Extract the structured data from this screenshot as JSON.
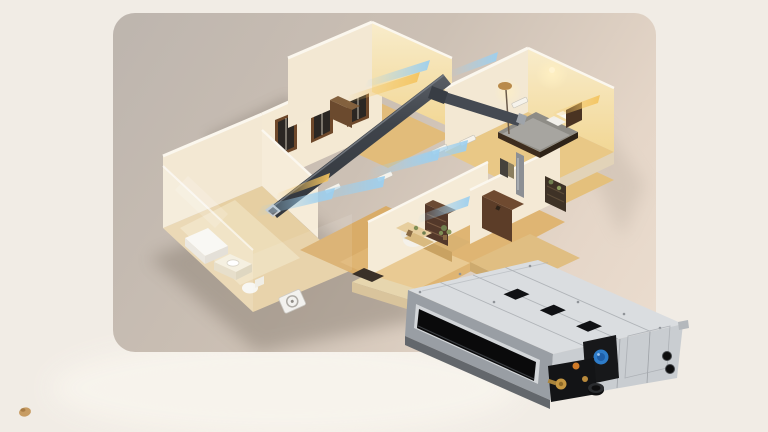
{
  "scene": {
    "description-elements": [
      "isometric-cutaway-house-model",
      "ceiling-air-duct",
      "cool-airflow-streams",
      "warm-airflow-streams",
      "bathroom-with-glass-wall",
      "dining-area",
      "wardrobe-room",
      "bedroom-with-bed-and-floor-lamp",
      "outdoor-condenser-unit",
      "ducted-ac-indoor-unit-product"
    ]
  },
  "colors": {
    "bg-outer": "#F1ECE5",
    "bg-glow": "#F8F4ED",
    "card-a": "#BDB5AE",
    "card-b": "#CCC0B4",
    "card-c": "#E5D6C8",
    "card-d": "#EBDDCF",
    "wall": "#F3E8D3",
    "wall-lit1": "#F8ECCB",
    "wall-lit2": "#F2D795",
    "wall-top": "#FBF7EE",
    "floor-wood": "#D9AC68",
    "floor-wood-light": "#E9C886",
    "floor-pale": "#E6CFA2",
    "duct-a": "#3F444B",
    "duct-b": "#5A5F66",
    "duct-cap": "#C9CCD0",
    "air-cool": "#9CCFEF",
    "air-warm": "#F4C45F",
    "shadow": "#857A6E",
    "unit-top-a": "#DADDE0",
    "unit-top-b": "#B5B9BE",
    "unit-front": "#999EA4",
    "unit-right-a": "#C9CDD1",
    "unit-right-b": "#AEB3B8",
    "unit-dark": "#0A0A0B",
    "unit-band": "#63676C",
    "unit-black": "#131416",
    "knob-blue": "#2E7CC9",
    "brass": "#C59742",
    "copper": "#D07B28",
    "wood-brown": "#6E482A",
    "crumb": "#C79C63"
  }
}
